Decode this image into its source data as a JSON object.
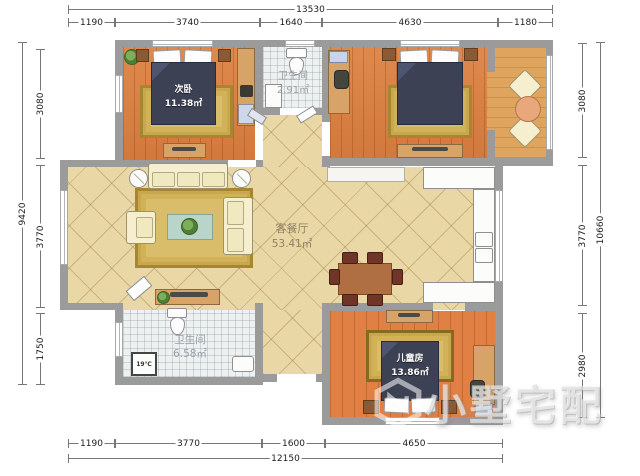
{
  "watermark": {
    "text": "小墅宅配"
  },
  "rooms": {
    "bedroom2": {
      "name": "次卧",
      "area": "11.38㎡"
    },
    "bath_top": {
      "name": "卫生间",
      "area": "2.91㎡"
    },
    "living": {
      "name": "客餐厅",
      "area": "53.41㎡"
    },
    "bath_bottom": {
      "name": "卫生间",
      "area": "6.58㎡"
    },
    "kids": {
      "name": "儿童房",
      "area": "13.86㎡"
    }
  },
  "appliances": {
    "heater_label": "19℃"
  },
  "dimensions": {
    "top_total": "13530",
    "top": [
      "1190",
      "3740",
      "1640",
      "4630",
      "1180"
    ],
    "bottom": [
      "1190",
      "3770",
      "1600",
      "4650"
    ],
    "bottom_total": "12150",
    "left": [
      "3080",
      "3770",
      "1750"
    ],
    "left_total": "9420",
    "right": [
      "3080",
      "3770",
      "2980"
    ],
    "right_total": "10660"
  },
  "colors": {
    "wall": "#9b9b9b",
    "wood": "#dd8040",
    "tile": "#e9d8a6",
    "bed": "#3c4154"
  }
}
